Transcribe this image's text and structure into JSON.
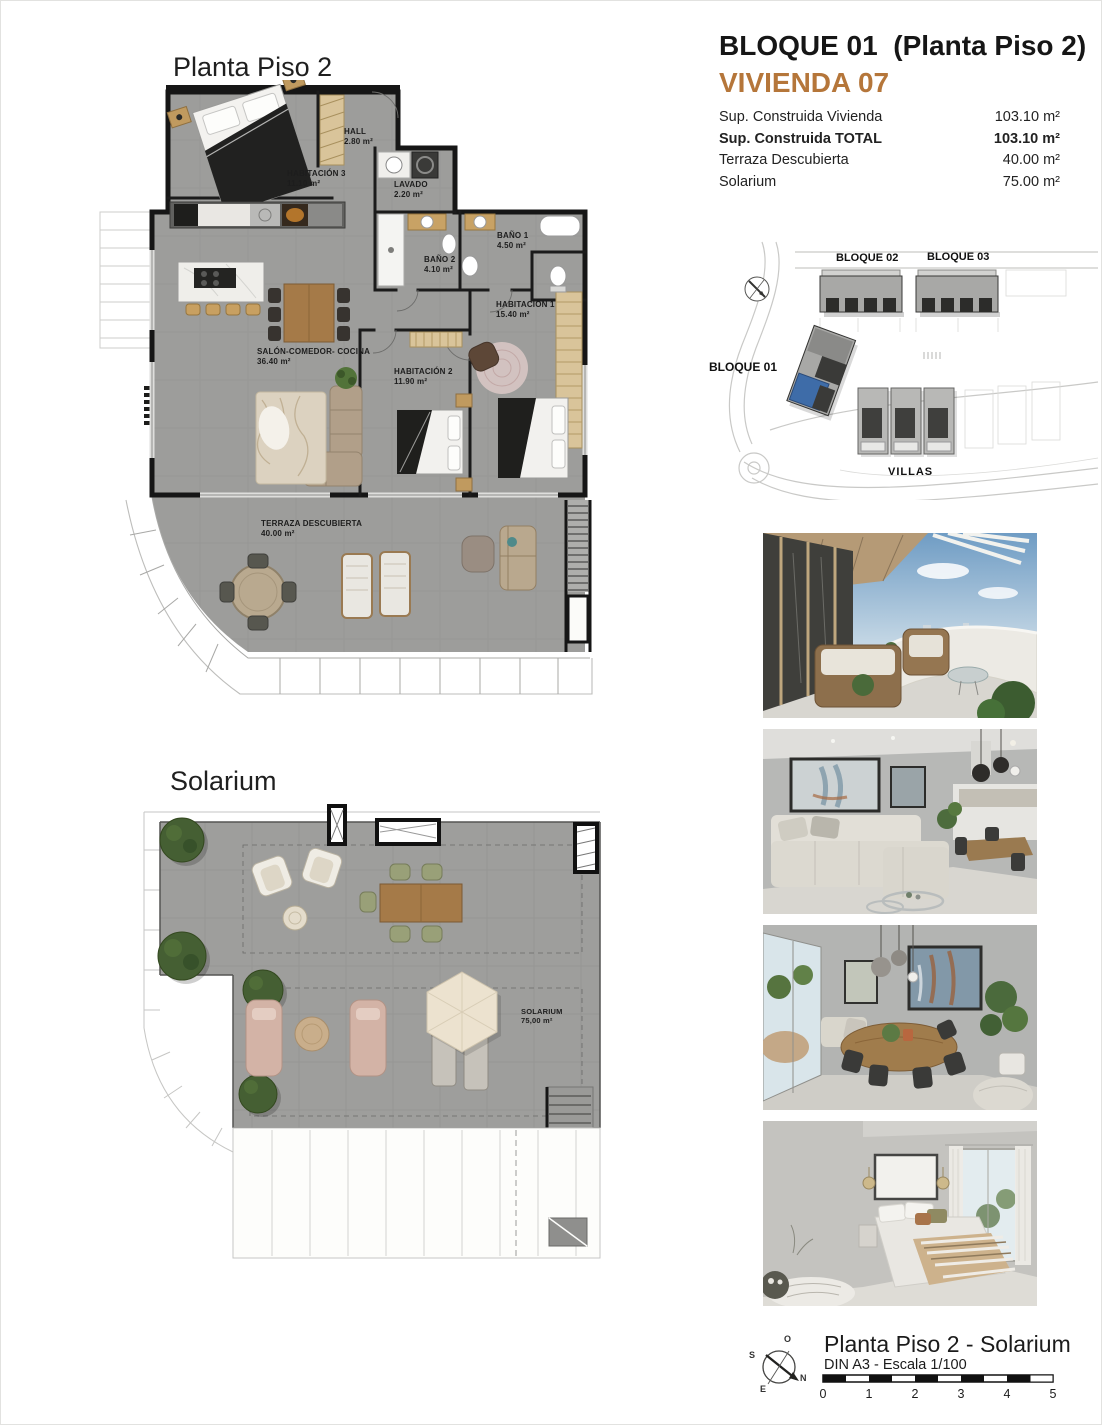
{
  "header": {
    "title": "BLOQUE 01  (Planta Piso 2)",
    "unit": "VIVIENDA 07",
    "accent_color": "#b5763a",
    "specs": [
      {
        "label": "Sup. Construida Vivienda",
        "value": "103.10 m²"
      },
      {
        "label": "Sup. Construida TOTAL",
        "value": "103.10 m²"
      },
      {
        "label": "Terraza Descubierta",
        "value": "40.00 m²"
      },
      {
        "label": "Solarium",
        "value": "75.00 m²"
      }
    ]
  },
  "floor_plan": {
    "title": "Planta Piso 2",
    "rooms": [
      {
        "name": "HABITACIÓN 3",
        "area": "11.10 m²"
      },
      {
        "name": "HALL",
        "area": "2.80 m²"
      },
      {
        "name": "LAVADO",
        "area": "2.20 m²"
      },
      {
        "name": "BAÑO 2",
        "area": "4.10 m²"
      },
      {
        "name": "BAÑO 1",
        "area": "4.50 m²"
      },
      {
        "name": "HABITACIÓN 1",
        "area": "15.40 m²"
      },
      {
        "name": "HABITACIÓN 2",
        "area": "11.90 m²"
      },
      {
        "name": "SALÓN-COMEDOR- COCINA",
        "area": "36.40 m²"
      },
      {
        "name": "TERRAZA DESCUBIERTA",
        "area": "40.00 m²"
      }
    ]
  },
  "solarium_plan": {
    "title": "Solarium",
    "room": {
      "name": "SOLARIUM",
      "area": "75,00 m²"
    }
  },
  "site_plan": {
    "labels": {
      "bloque01": "BLOQUE 01",
      "bloque02": "BLOQUE 02",
      "bloque03": "BLOQUE 03",
      "villas": "VILLAS"
    },
    "highlight_color": "#3e6ca8"
  },
  "photos": [
    {
      "name": "terrace-view"
    },
    {
      "name": "living-room"
    },
    {
      "name": "dining-room"
    },
    {
      "name": "bedroom"
    }
  ],
  "footer": {
    "title": "Planta Piso 2 - Solarium",
    "scale_note": "DIN A3 - Escala 1/100",
    "scale_ticks": [
      "0",
      "1",
      "2",
      "3",
      "4",
      "5"
    ],
    "compass": {
      "n": "N",
      "s": "S",
      "e": "E",
      "o": "O"
    }
  }
}
